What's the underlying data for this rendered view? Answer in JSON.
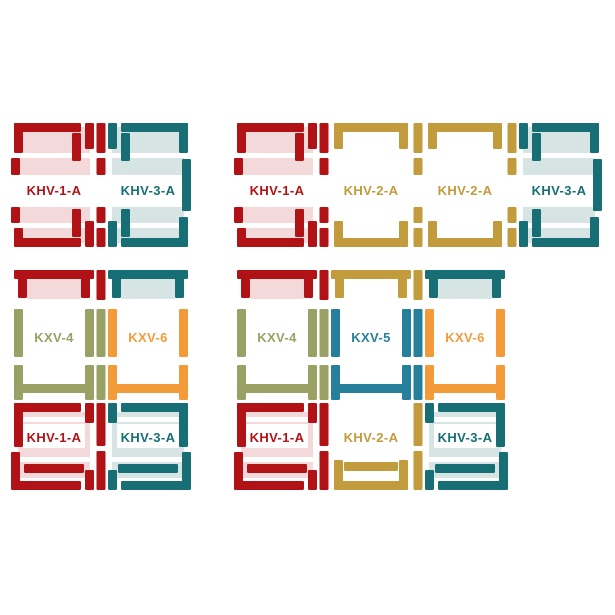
{
  "figure": {
    "width": 615,
    "height": 615,
    "background": "#ffffff"
  },
  "colors": {
    "red": "#b11216",
    "pink": "#f3d9da",
    "teal": "#176f75",
    "lightteal": "#d6e4e4",
    "gold": "#c19b3c",
    "olive": "#99a164",
    "orange": "#f39b39",
    "blue": "#27809b",
    "white": "#ffffff"
  },
  "groups": [
    {
      "id": "top-left",
      "x": 14,
      "y": 123,
      "rows": [
        {
          "kind": "khv",
          "height": 124,
          "cells": [
            {
              "label": "KHV-1-A",
              "color": "red",
              "tint": "pink",
              "anchor": "left"
            },
            {
              "label": "KHV-3-A",
              "color": "teal",
              "tint": "lightteal",
              "anchor": "right"
            }
          ]
        }
      ]
    },
    {
      "id": "top-right",
      "x": 237,
      "y": 123,
      "rows": [
        {
          "kind": "khv",
          "height": 124,
          "cells": [
            {
              "label": "KHV-1-A",
              "color": "red",
              "tint": "pink",
              "anchor": "left"
            },
            {
              "label": "KHV-2-A",
              "color": "gold",
              "tint": null,
              "anchor": "mid"
            },
            {
              "label": "KHV-2-A",
              "color": "gold",
              "tint": null,
              "anchor": "mid"
            },
            {
              "label": "KHV-3-A",
              "color": "teal",
              "tint": "lightteal",
              "anchor": "right"
            }
          ]
        }
      ]
    },
    {
      "id": "bottom-left",
      "x": 14,
      "y": 270,
      "rows": [
        {
          "kind": "kxv",
          "height": 130,
          "cells": [
            {
              "label": "KXV-4",
              "color": "olive",
              "top_color": "red",
              "tint": "pink"
            },
            {
              "label": "KXV-6",
              "color": "orange",
              "top_color": "teal",
              "tint": "lightteal"
            }
          ]
        },
        {
          "kind": "khv2",
          "height": 90,
          "cells": [
            {
              "label": "KHV-1-A",
              "color": "red",
              "tint": "pink",
              "anchor": "left"
            },
            {
              "label": "KHV-3-A",
              "color": "teal",
              "tint": "lightteal",
              "anchor": "right"
            }
          ]
        }
      ]
    },
    {
      "id": "bottom-right",
      "x": 237,
      "y": 270,
      "rows": [
        {
          "kind": "kxv",
          "height": 130,
          "cells": [
            {
              "label": "KXV-4",
              "color": "olive",
              "top_color": "red",
              "tint": "pink"
            },
            {
              "label": "KXV-5",
              "color": "blue",
              "top_color": "gold",
              "tint": null
            },
            {
              "label": "KXV-6",
              "color": "orange",
              "top_color": "teal",
              "tint": "lightteal"
            }
          ]
        },
        {
          "kind": "khv2",
          "height": 90,
          "cells": [
            {
              "label": "KHV-1-A",
              "color": "red",
              "tint": "pink",
              "anchor": "left"
            },
            {
              "label": "KHV-2-A",
              "color": "gold",
              "tint": null,
              "anchor": "mid"
            },
            {
              "label": "KHV-3-A",
              "color": "teal",
              "tint": "lightteal",
              "anchor": "right"
            }
          ]
        }
      ]
    }
  ]
}
